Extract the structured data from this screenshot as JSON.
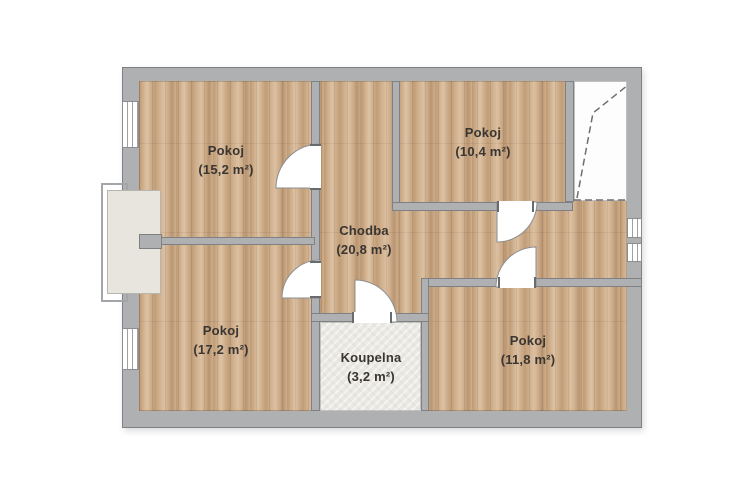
{
  "colors": {
    "paper": "#ffffff",
    "wall": "#aeb0b2",
    "wallLine": "#7e8083",
    "wood": "#cfae8b",
    "tile": "#eae8e3",
    "balcony": "#e8e5df",
    "label": "#3a3531",
    "doorLine": "#8b8d90",
    "dashLine": "#6f6f6f"
  },
  "rooms": [
    {
      "id": "room-top-left",
      "name": "Pokoj",
      "area": "(15,2 m²)"
    },
    {
      "id": "room-top-right",
      "name": "Pokoj",
      "area": "(10,4 m²)"
    },
    {
      "id": "hallway",
      "name": "Chodba",
      "area": "(20,8 m²)"
    },
    {
      "id": "room-bottom-left",
      "name": "Pokoj",
      "area": "(17,2 m²)"
    },
    {
      "id": "bathroom",
      "name": "Koupelna",
      "area": "(3,2 m²)"
    },
    {
      "id": "room-bottom-right",
      "name": "Pokoj",
      "area": "(11,8 m²)"
    }
  ]
}
